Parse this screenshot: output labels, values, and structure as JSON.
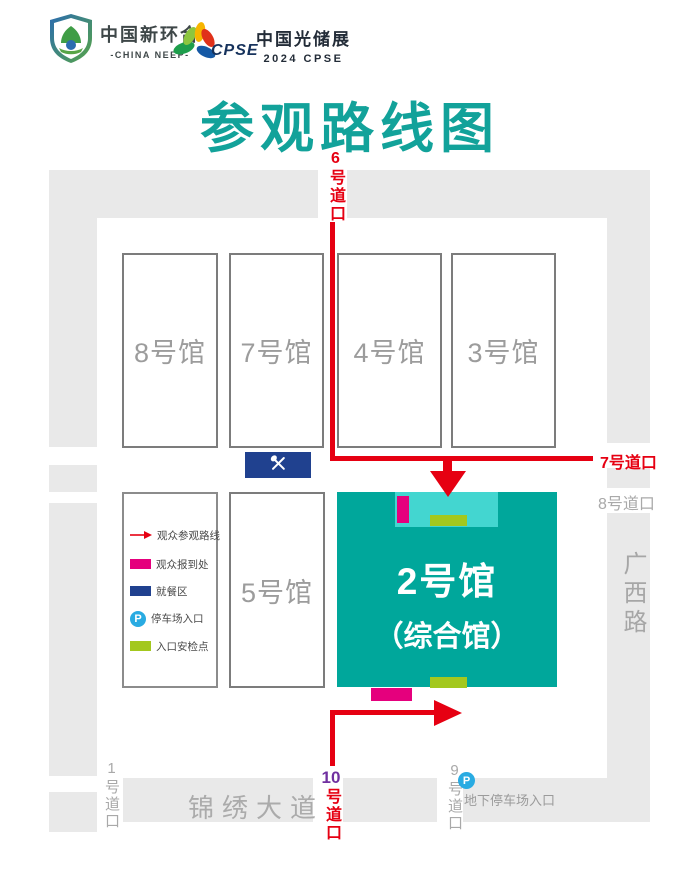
{
  "header": {
    "brand1": {
      "cn": "中国新环合",
      "en": "-CHINA NEEP-"
    },
    "brand2": {
      "acronym": "CPSE",
      "cn": "中国光储展",
      "sub": "2024 CPSE"
    },
    "title": "参观路线图"
  },
  "halls": [
    {
      "label": "8号馆"
    },
    {
      "label": "7号馆"
    },
    {
      "label": "4号馆"
    },
    {
      "label": "3号馆"
    },
    {
      "label": "5号馆"
    }
  ],
  "main_hall": {
    "line1": "2号馆",
    "line2": "（综合馆）"
  },
  "legend": {
    "items": [
      {
        "label": "观众参观路线"
      },
      {
        "label": "观众报到处"
      },
      {
        "label": "就餐区"
      },
      {
        "label": "停车场入口"
      },
      {
        "label": "入口安检点"
      }
    ],
    "parking_symbol": "P"
  },
  "gates": {
    "gate1": "1号道口",
    "gate6": "6号道口",
    "gate7": "7号道口",
    "gate8": "8号道口",
    "gate9": "9号道口",
    "gate10_num": "10",
    "gate10_suffix": "号道口"
  },
  "roads": {
    "jinxiu_avenue": "锦绣大道",
    "guangxi_road": "广西路",
    "underground_parking": "地下停车场入口",
    "parking_symbol": "P"
  },
  "colors": {
    "teal": "#00a79b",
    "entrance_cyan": "#43d6d0",
    "registration_magenta": "#e5007d",
    "dining_navy": "#20418f",
    "security_green": "#a3c81e",
    "route_red": "#e60012",
    "gate10_purple": "#7030a0",
    "road_gray": "#e9e9e9",
    "parking_blue": "#29abe2",
    "title_teal": "#12a29a"
  }
}
